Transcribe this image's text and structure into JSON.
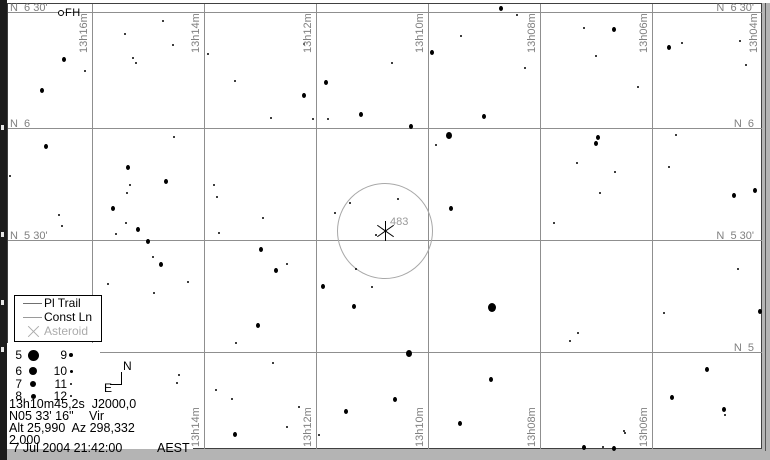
{
  "window": {
    "bg": "#b4b4b4",
    "chart_bg": "#ffffff"
  },
  "colors": {
    "grid": "#8f8f8f",
    "coord_label": "#808080",
    "fov_circle": "#a8a8a8",
    "disabled_text": "#ababab",
    "star": "#000000"
  },
  "chart": {
    "ra_lines_x": [
      92,
      204,
      316,
      428,
      540,
      652
    ],
    "ra_top_labels": [
      {
        "text": "13h16m",
        "x": 92
      },
      {
        "text": "13h14m",
        "x": 204
      },
      {
        "text": "13h12m",
        "x": 316
      },
      {
        "text": "13h10m",
        "x": 428
      },
      {
        "text": "13h08m",
        "x": 540
      },
      {
        "text": "13h06m",
        "x": 652
      },
      {
        "text": "13h04m",
        "x": 762
      }
    ],
    "ra_bottom_labels": [
      {
        "text": "13h14m",
        "x": 204
      },
      {
        "text": "13h12m",
        "x": 316
      },
      {
        "text": "13h10m",
        "x": 428
      },
      {
        "text": "13h08m",
        "x": 540
      },
      {
        "text": "13h06m",
        "x": 652
      }
    ],
    "dec_lines": [
      {
        "y": 12,
        "x_start": 8
      },
      {
        "y": 128,
        "x_start": 8
      },
      {
        "y": 240,
        "x_start": 8
      },
      {
        "y": 352,
        "x_start": 100
      }
    ],
    "dec_left_labels": [
      {
        "text": "N  6 30'",
        "y": 12
      },
      {
        "text": "N  6",
        "y": 128
      },
      {
        "text": "N  5 30'",
        "y": 240
      }
    ],
    "dec_right_labels": [
      {
        "text": "N  6 30'",
        "y": 12
      },
      {
        "text": "N  6",
        "y": 128
      },
      {
        "text": "N  5 30'",
        "y": 240
      },
      {
        "text": "N  5",
        "y": 352
      }
    ],
    "fov_circle": {
      "cx": 385,
      "cy": 231,
      "r": 48
    },
    "asteroid_marker": {
      "x": 386,
      "y": 231,
      "label": "483"
    },
    "comet_marker": {
      "label": "FH"
    },
    "stars": [
      [
        64,
        59,
        4
      ],
      [
        85,
        71,
        2
      ],
      [
        42,
        90,
        4
      ],
      [
        125,
        34,
        2
      ],
      [
        133,
        58,
        2
      ],
      [
        136,
        63,
        2
      ],
      [
        173,
        45,
        2
      ],
      [
        163,
        21,
        2
      ],
      [
        208,
        54,
        2
      ],
      [
        235,
        81,
        2
      ],
      [
        271,
        118,
        2
      ],
      [
        304,
        44,
        2
      ],
      [
        326,
        82,
        4
      ],
      [
        304,
        95,
        4
      ],
      [
        313,
        119,
        2
      ],
      [
        328,
        119,
        2
      ],
      [
        361,
        114,
        4
      ],
      [
        174,
        137,
        2
      ],
      [
        46,
        146,
        4
      ],
      [
        128,
        167,
        4
      ],
      [
        501,
        8,
        4
      ],
      [
        517,
        15,
        2
      ],
      [
        432,
        52,
        4
      ],
      [
        461,
        36,
        2
      ],
      [
        392,
        63,
        2
      ],
      [
        525,
        68,
        2
      ],
      [
        584,
        28,
        2
      ],
      [
        614,
        29,
        4
      ],
      [
        596,
        56,
        2
      ],
      [
        638,
        87,
        2
      ],
      [
        669,
        47,
        4
      ],
      [
        682,
        43,
        2
      ],
      [
        740,
        41,
        2
      ],
      [
        746,
        65,
        2
      ],
      [
        484,
        116,
        4
      ],
      [
        411,
        126,
        4
      ],
      [
        449,
        135,
        6
      ],
      [
        436,
        145,
        2
      ],
      [
        598,
        137,
        4
      ],
      [
        596,
        143,
        4
      ],
      [
        676,
        135,
        2
      ],
      [
        577,
        163,
        2
      ],
      [
        669,
        167,
        2
      ],
      [
        10,
        176,
        2
      ],
      [
        166,
        181,
        4
      ],
      [
        113,
        208,
        4
      ],
      [
        130,
        185,
        2
      ],
      [
        127,
        193,
        2
      ],
      [
        138,
        229,
        4
      ],
      [
        126,
        223,
        2
      ],
      [
        116,
        234,
        2
      ],
      [
        148,
        241,
        4
      ],
      [
        153,
        257,
        2
      ],
      [
        161,
        264,
        4
      ],
      [
        108,
        284,
        2
      ],
      [
        154,
        293,
        2
      ],
      [
        188,
        282,
        2
      ],
      [
        59,
        215,
        2
      ],
      [
        62,
        226,
        2
      ],
      [
        214,
        185,
        2
      ],
      [
        217,
        197,
        2
      ],
      [
        219,
        233,
        2
      ],
      [
        261,
        249,
        4
      ],
      [
        263,
        218,
        2
      ],
      [
        276,
        270,
        4
      ],
      [
        287,
        264,
        2
      ],
      [
        323,
        286,
        4
      ],
      [
        335,
        213,
        2
      ],
      [
        350,
        203,
        2
      ],
      [
        354,
        306,
        4
      ],
      [
        372,
        287,
        2
      ],
      [
        376,
        235,
        2
      ],
      [
        356,
        269,
        2
      ],
      [
        451,
        208,
        4
      ],
      [
        398,
        199,
        2
      ],
      [
        600,
        193,
        2
      ],
      [
        615,
        172,
        2
      ],
      [
        554,
        223,
        2
      ],
      [
        734,
        195,
        4
      ],
      [
        755,
        190,
        4
      ],
      [
        738,
        269,
        2
      ],
      [
        492,
        307,
        8
      ],
      [
        664,
        313,
        2
      ],
      [
        760,
        311,
        4
      ],
      [
        258,
        325,
        4
      ],
      [
        236,
        343,
        2
      ],
      [
        409,
        353,
        6
      ],
      [
        273,
        363,
        2
      ],
      [
        179,
        375,
        2
      ],
      [
        177,
        383,
        2
      ],
      [
        216,
        390,
        2
      ],
      [
        232,
        399,
        2
      ],
      [
        299,
        407,
        2
      ],
      [
        287,
        427,
        2
      ],
      [
        235,
        434,
        4
      ],
      [
        319,
        435,
        2
      ],
      [
        346,
        411,
        4
      ],
      [
        395,
        399,
        4
      ],
      [
        578,
        333,
        2
      ],
      [
        570,
        341,
        2
      ],
      [
        491,
        379,
        4
      ],
      [
        460,
        423,
        4
      ],
      [
        707,
        369,
        4
      ],
      [
        672,
        397,
        4
      ],
      [
        724,
        409,
        4
      ],
      [
        725,
        415,
        2
      ],
      [
        584,
        447,
        4
      ],
      [
        603,
        447,
        2
      ],
      [
        614,
        448,
        4
      ],
      [
        625,
        433,
        2
      ],
      [
        624,
        431,
        2
      ]
    ]
  },
  "legend": {
    "items": [
      {
        "symbol": "trail-line",
        "label": "Pl Trail",
        "text_color": "#000000",
        "line_color": "#707070"
      },
      {
        "symbol": "const-line",
        "label": "Const Ln",
        "text_color": "#000000",
        "line_color": "#9a9a9a"
      },
      {
        "symbol": "asteroid-x",
        "label": "Asteroid",
        "text_color": "#ababab"
      }
    ]
  },
  "magnitude_scale": {
    "rows": [
      {
        "left": "5",
        "left_dot": 11,
        "right": "9",
        "right_dot": 4
      },
      {
        "left": "6",
        "left_dot": 8,
        "right": "10",
        "right_dot": 3
      },
      {
        "left": "7",
        "left_dot": 6,
        "right": "11",
        "right_dot": 2
      },
      {
        "left": "8",
        "left_dot": 5,
        "right": "12",
        "right_dot": 2
      }
    ]
  },
  "compass": {
    "north": "N",
    "east": "E"
  },
  "info": {
    "line1": "13h10m45,2s  J2000,0",
    "line2_coord": "N05 33' 16\"",
    "line2_const": "Vir",
    "line3": "Alt 25,990  Az 298,332",
    "line4": "2,000",
    "line5_datetime": " 7 Jul 2004 21:42:00",
    "line5_tz": "AEST"
  }
}
